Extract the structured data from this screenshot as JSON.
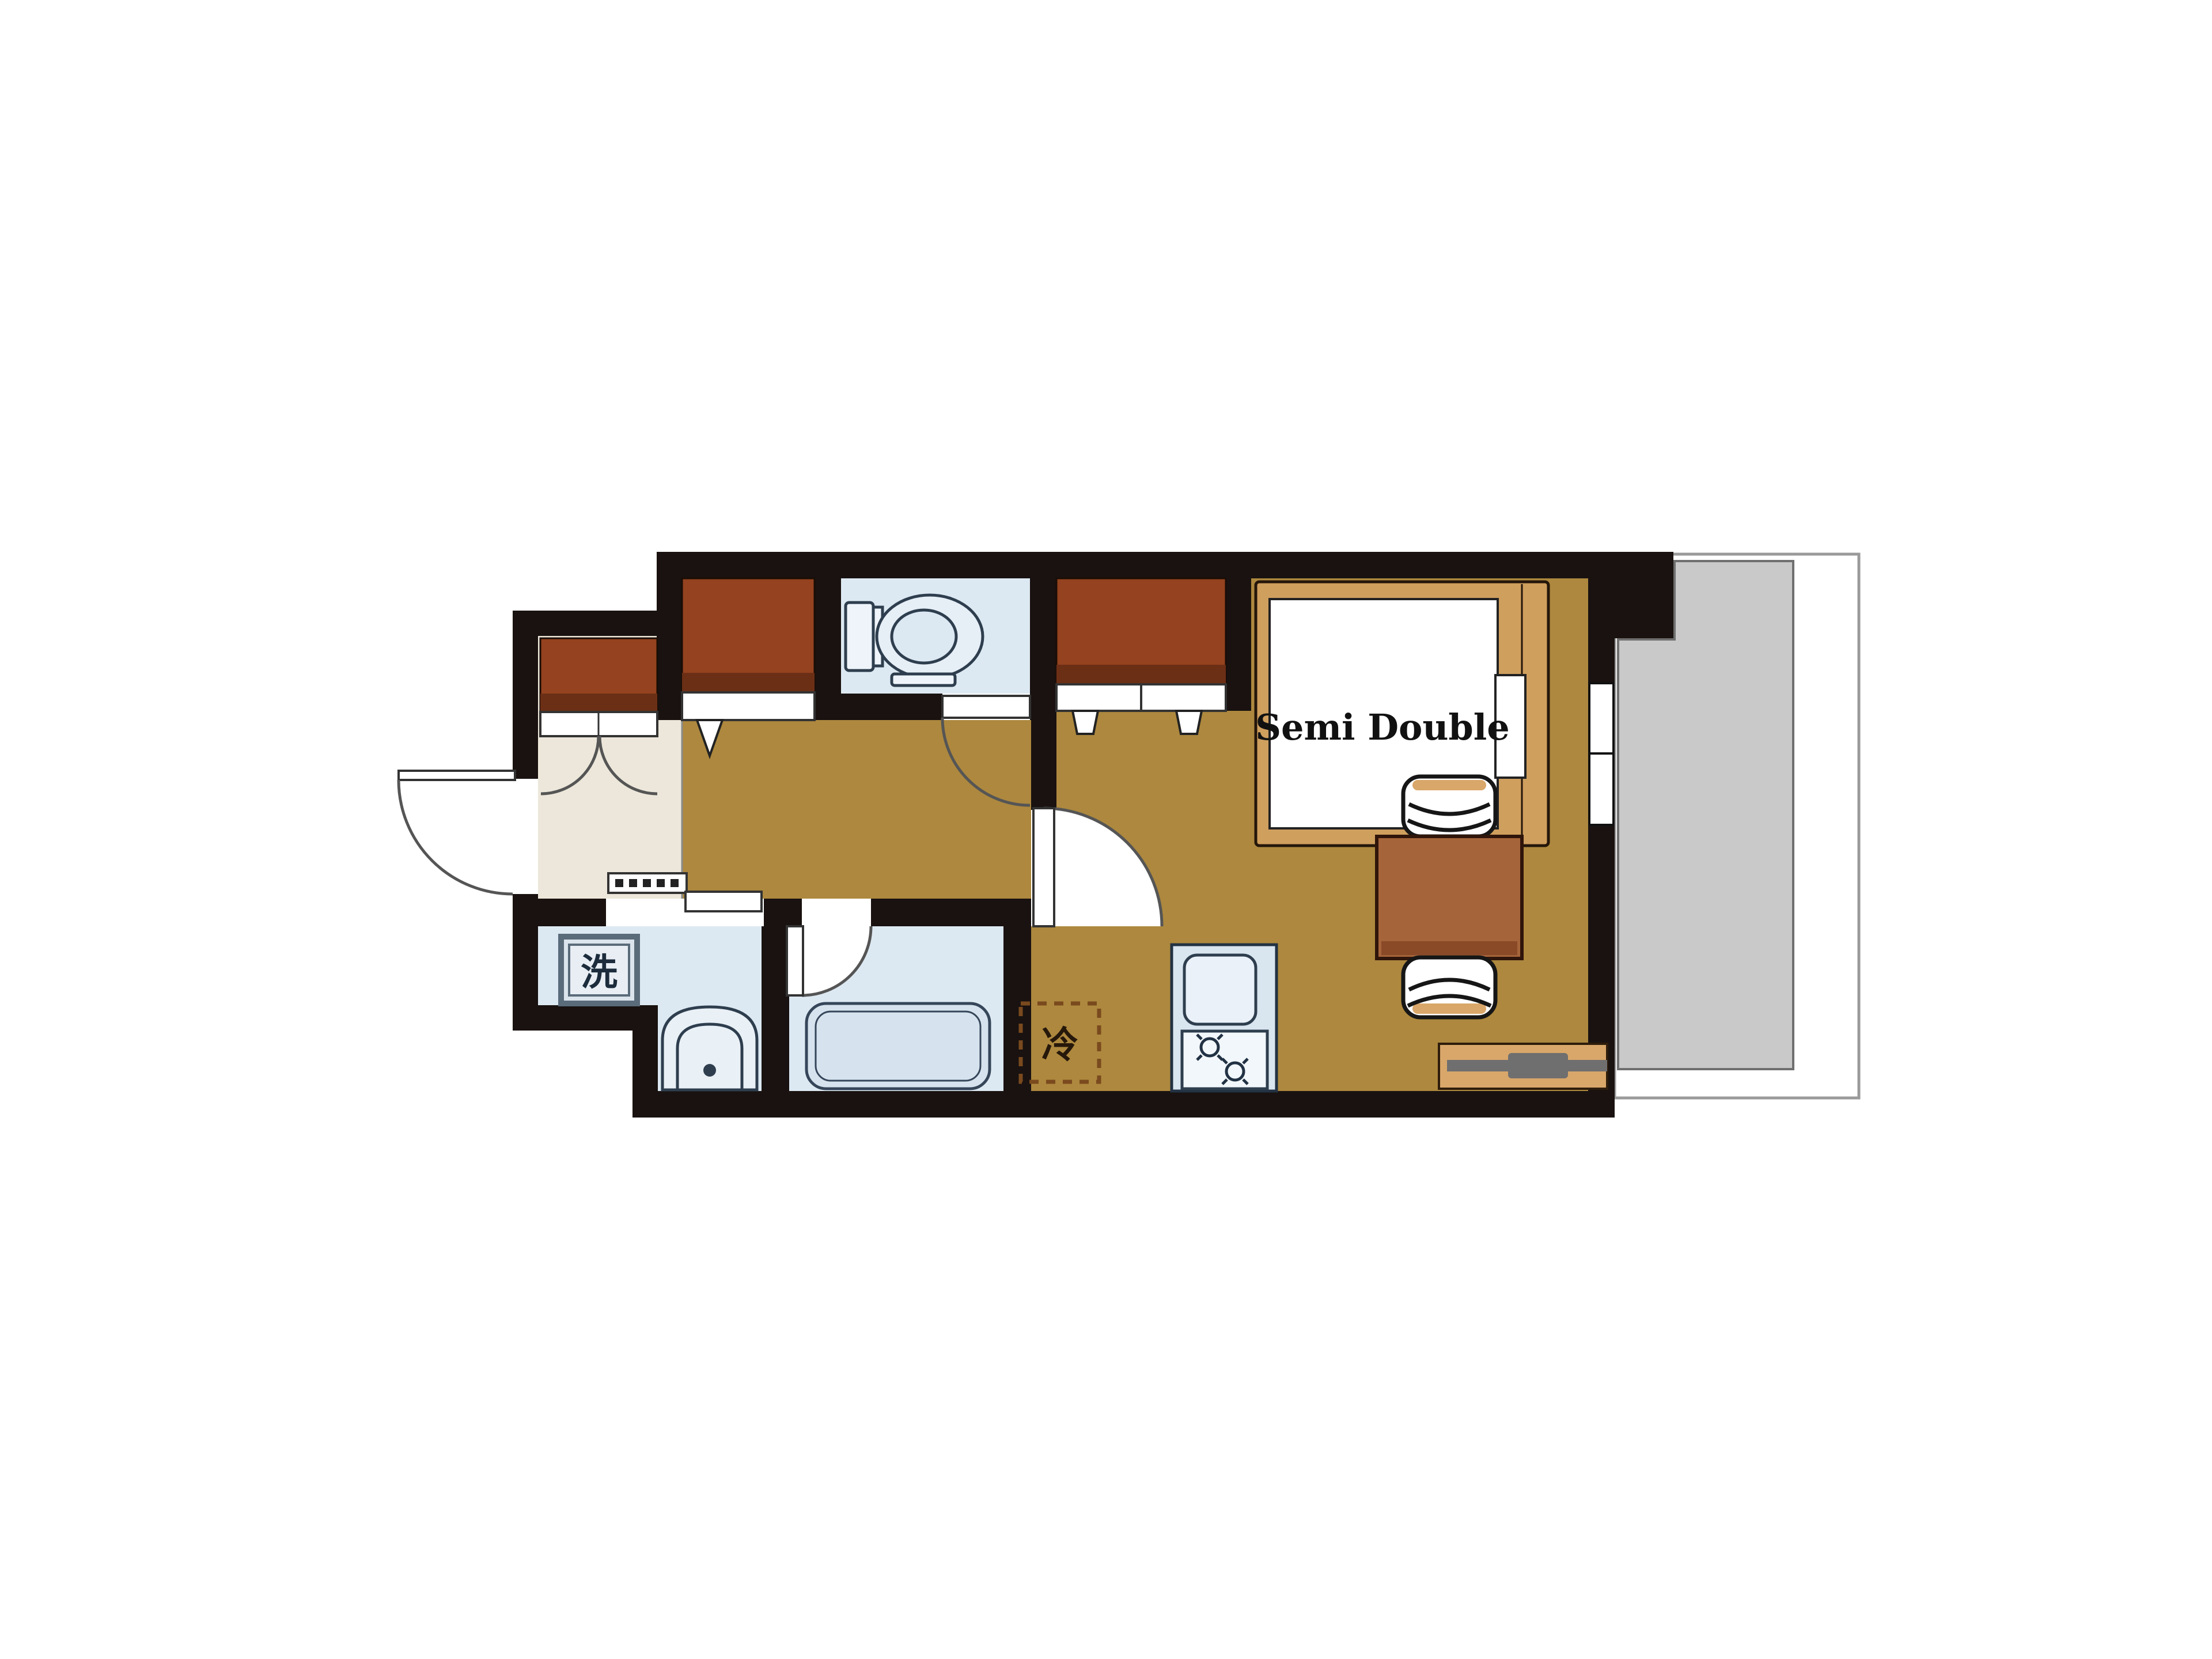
{
  "title": "one-room apartment floor plan",
  "labels": {
    "bed": "Semi Double",
    "washer": "洗",
    "fridge": "冷"
  },
  "colors": {
    "wall": "#191210",
    "floor": "#ad883e",
    "genkan": "#ece7da",
    "water_room": "#dde9f2",
    "counter": "#d9e5ef",
    "counter_sink": "#eaf1f8",
    "stove": "#f2f7fb",
    "tub": "#d6e3ee",
    "balcony_floor": "#c9c9c9",
    "balcony_border": "#6f6f6f",
    "closet": "#94421f",
    "closet_shade": "#6b2f16",
    "table": "#a5643a",
    "table_shade": "#8a4a28",
    "bed_frame": "#cf9f5e",
    "mattress": "#ffffff",
    "tv_board": "#d9a76a",
    "tv_gray": "#6f6f6f",
    "fridge_dash": "#7a4a1e",
    "washer_box": "#dbe4ec",
    "text_dark": "#111111"
  }
}
